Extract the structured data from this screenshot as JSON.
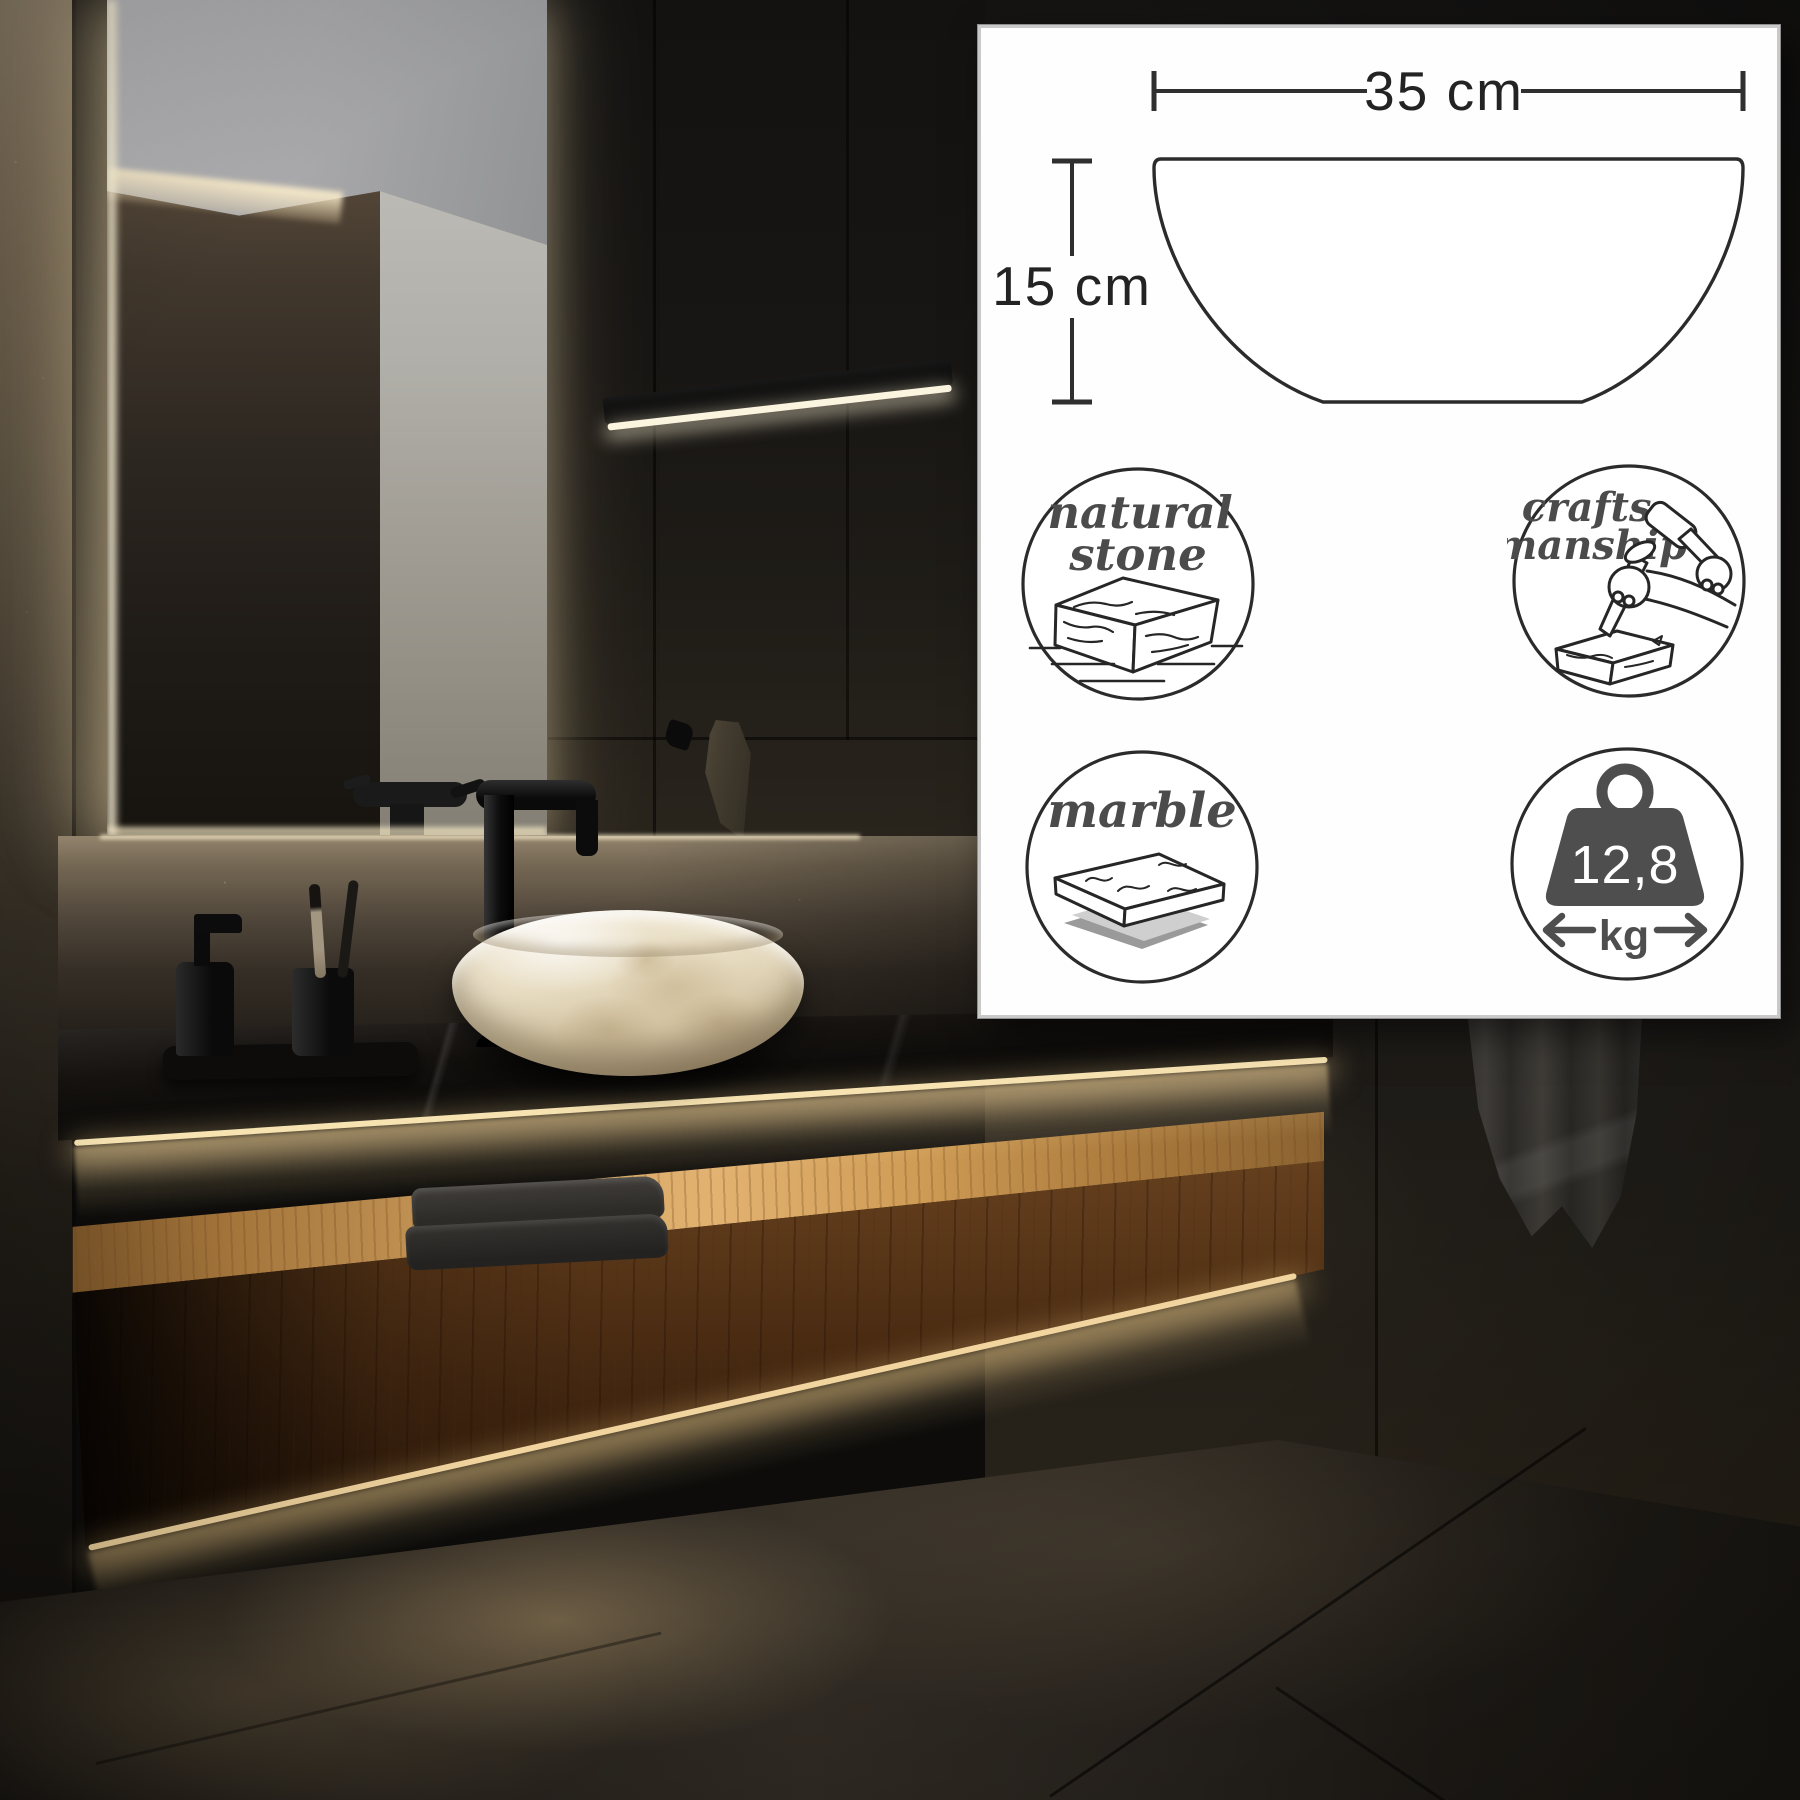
{
  "panel": {
    "size_diagram": {
      "width_label": "35 cm",
      "height_label": "15 cm"
    },
    "badges": {
      "natural_stone": {
        "line1": "natural",
        "line2": "stone"
      },
      "craftsmanship": {
        "line1": "crafts-",
        "line2": "manship"
      },
      "marble": {
        "label": "marble"
      },
      "weight": {
        "value": "12,8",
        "unit": "kg"
      }
    },
    "colors": {
      "panel_bg": "#fefefe",
      "border": "#c9c9c9",
      "line_art": "#262626",
      "script_text": "#4b4b4b",
      "weight_fill": "#4e4e4e"
    }
  },
  "scene": {
    "label": "dark luxury bathroom with round marble vessel sink on black stone counter and walnut floating cabinet",
    "elements": [
      "backlit-mirror",
      "pendant-light-bar",
      "black-faucet",
      "marble-vessel-sink",
      "soap-dispenser",
      "toothbrush-cup",
      "black-stone-countertop",
      "walnut-floating-cabinet",
      "folded-towels",
      "hanging-towel",
      "wall-hook-towel",
      "slate-walls",
      "tiled-floor"
    ]
  }
}
